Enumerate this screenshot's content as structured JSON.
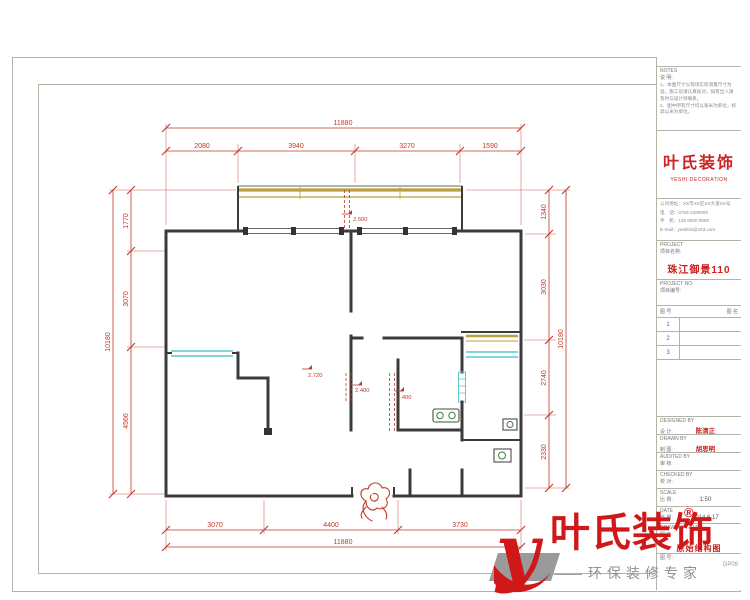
{
  "document": {
    "type": "CAD floor plan sheet",
    "sheet_border_color": "#b3b3a6"
  },
  "colors": {
    "dimension_red": "#c0392b",
    "wall_dark": "#3b3b3b",
    "window_tan": "#b99f3f",
    "window_cyan": "#5cc9c9",
    "brand_red": "#cc2222",
    "logo_gray": "#9a9a9a"
  },
  "dims": {
    "top_total": "11880",
    "top_parts": [
      "2080",
      "3940",
      "3270",
      "1590"
    ],
    "bottom_parts": [
      "3070",
      "4400",
      "3730"
    ],
    "bottom_total": "11880",
    "left_total": "10180",
    "left_parts": [
      "1770",
      "3070",
      "4566"
    ],
    "right_total": "10180",
    "right_parts": [
      "1340",
      "3030",
      "2740",
      "2330"
    ]
  },
  "levels": {
    "top": "2.500",
    "living": "2.720",
    "bath_a": "2.400",
    "bath_b": "2.400"
  },
  "title_block": {
    "notes_label": "NOTES",
    "notes_sub": "说 明:",
    "notes_line1": "1、本图尺寸以现场实际测量尺寸为准，施工前请认真核对，如有出入请及时与设计师联系。",
    "notes_line2": "2、图中所有尺寸均以毫米为单位，标高以米为单位。",
    "company_name": "叶氏装饰",
    "company_en": "YESHI DECORATION",
    "contact_line1": "公司地址：XX市XX区XX大道XX号",
    "contact_line2": "电　话：0753-2280000",
    "contact_line3": "手　机：135 0000 0000",
    "contact_line4": "E-mail：yeshizs@163.com",
    "project_label": "PROJECT",
    "project_sub": "项目名称:",
    "project_name": "珠江御景110",
    "project_no_label": "PROJECT  NO.",
    "project_no_sub": "项目编号:",
    "table_header_left": "图 号",
    "table_header_right": "图 名",
    "table_rows": [
      "1",
      "2",
      "3"
    ],
    "designed_label": "DESIGNED BY",
    "designed_sub": "设 计:",
    "designed_name": "陈清正",
    "drawn_label": "DRAWN BY",
    "drawn_sub": "制 图:",
    "drawn_name": "胡思明",
    "audited_label": "AUDITED BY",
    "audited_sub": "审 核:",
    "checked_label": "CHECKED BY",
    "checked_sub": "校 对:",
    "scale_label": "SCALE",
    "scale_sub": "比 例:",
    "scale_value": "1:50",
    "date_label": "DATE",
    "date_sub": "日 期:",
    "date_value": "2014.6.17",
    "drawing_title_label": "DRAWING TITLE",
    "drawing_title_sub": "图 名:",
    "drawing_title_value": "原始结构图",
    "drawing_no_label": "图 号:",
    "drawing_no_value": "GP09"
  },
  "logo": {
    "name": "叶氏装饰",
    "reg": "®",
    "tagline_dash": "——",
    "tagline": "环保装修专家"
  }
}
